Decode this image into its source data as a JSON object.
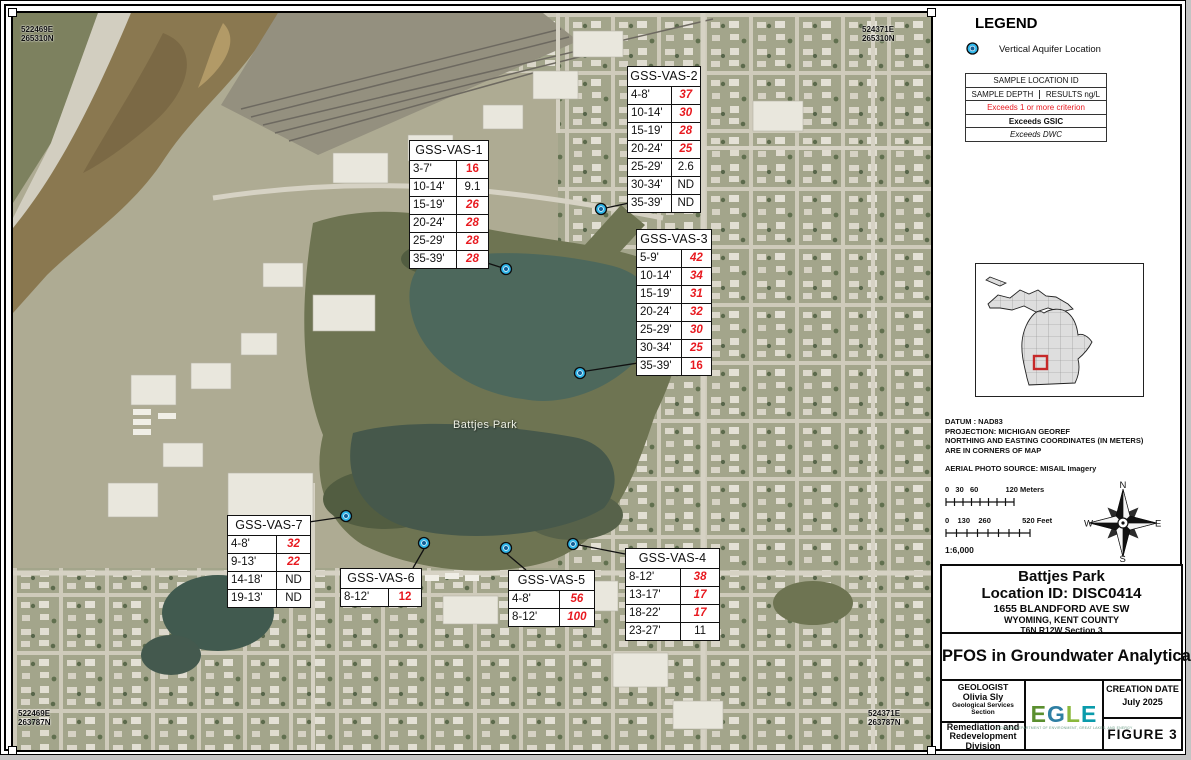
{
  "map": {
    "park_label": "Battjes Park",
    "corners": {
      "tl": {
        "e": "522469E",
        "n": "265310N"
      },
      "tr": {
        "e": "524371E",
        "n": "265310N"
      },
      "bl": {
        "e": "522469E",
        "n": "263787N"
      },
      "br": {
        "e": "524371E",
        "n": "263787N"
      }
    }
  },
  "stations": [
    {
      "name": "GSS-VAS-1",
      "table": {
        "x": 396,
        "y": 127,
        "w": 78
      },
      "marker": {
        "x": 493,
        "y": 256
      },
      "line": [
        468,
        248,
        493,
        256
      ],
      "rows": [
        {
          "depth": "3-7'",
          "value": "16",
          "style": "red_bold"
        },
        {
          "depth": "10-14'",
          "value": "9.1",
          "style": "plain"
        },
        {
          "depth": "15-19'",
          "value": "26",
          "style": "red_bold_italic"
        },
        {
          "depth": "20-24'",
          "value": "28",
          "style": "red_bold_italic"
        },
        {
          "depth": "25-29'",
          "value": "28",
          "style": "red_bold_italic"
        },
        {
          "depth": "35-39'",
          "value": "28",
          "style": "red_bold_italic"
        }
      ]
    },
    {
      "name": "GSS-VAS-2",
      "table": {
        "x": 614,
        "y": 53,
        "w": 72
      },
      "marker": {
        "x": 588,
        "y": 196
      },
      "line": [
        616,
        190,
        588,
        196
      ],
      "rows": [
        {
          "depth": "4-8'",
          "value": "37",
          "style": "red_bold_italic"
        },
        {
          "depth": "10-14'",
          "value": "30",
          "style": "red_bold_italic"
        },
        {
          "depth": "15-19'",
          "value": "28",
          "style": "red_bold_italic"
        },
        {
          "depth": "20-24'",
          "value": "25",
          "style": "red_bold_italic"
        },
        {
          "depth": "25-29'",
          "value": "2.6",
          "style": "plain"
        },
        {
          "depth": "30-34'",
          "value": "ND",
          "style": "plain"
        },
        {
          "depth": "35-39'",
          "value": "ND",
          "style": "plain"
        }
      ]
    },
    {
      "name": "GSS-VAS-3",
      "table": {
        "x": 623,
        "y": 216,
        "w": 74
      },
      "marker": {
        "x": 567,
        "y": 360
      },
      "line": [
        625,
        350,
        567,
        359
      ],
      "rows": [
        {
          "depth": "5-9'",
          "value": "42",
          "style": "red_bold_italic"
        },
        {
          "depth": "10-14'",
          "value": "34",
          "style": "red_bold_italic"
        },
        {
          "depth": "15-19'",
          "value": "31",
          "style": "red_bold_italic"
        },
        {
          "depth": "20-24'",
          "value": "32",
          "style": "red_bold_italic"
        },
        {
          "depth": "25-29'",
          "value": "30",
          "style": "red_bold_italic"
        },
        {
          "depth": "30-34'",
          "value": "25",
          "style": "red_bold_italic"
        },
        {
          "depth": "35-39'",
          "value": "16",
          "style": "red_bold"
        }
      ]
    },
    {
      "name": "GSS-VAS-7",
      "table": {
        "x": 214,
        "y": 502,
        "w": 82
      },
      "marker": {
        "x": 333,
        "y": 503
      },
      "line": [
        296,
        509,
        330,
        504
      ],
      "rows": [
        {
          "depth": "4-8'",
          "value": "32",
          "style": "red_bold_italic"
        },
        {
          "depth": "9-13'",
          "value": "22",
          "style": "red_bold_italic"
        },
        {
          "depth": "14-18'",
          "value": "ND",
          "style": "plain"
        },
        {
          "depth": "19-13'",
          "value": "ND",
          "style": "plain"
        }
      ]
    },
    {
      "name": "GSS-VAS-6",
      "table": {
        "x": 327,
        "y": 555,
        "w": 80
      },
      "marker": {
        "x": 411,
        "y": 530
      },
      "line": [
        400,
        555,
        411,
        536
      ],
      "rows": [
        {
          "depth": "8-12'",
          "value": "12",
          "style": "red_bold"
        }
      ]
    },
    {
      "name": "GSS-VAS-5",
      "table": {
        "x": 495,
        "y": 557,
        "w": 85
      },
      "marker": {
        "x": 493,
        "y": 535
      },
      "line": [
        513,
        557,
        494,
        541
      ],
      "rows": [
        {
          "depth": "4-8'",
          "value": "56",
          "style": "red_bold_italic"
        },
        {
          "depth": "8-12'",
          "value": "100",
          "style": "red_bold_italic"
        }
      ]
    },
    {
      "name": "GSS-VAS-4",
      "table": {
        "x": 612,
        "y": 535,
        "w": 93
      },
      "marker": {
        "x": 560,
        "y": 531
      },
      "line": [
        612,
        541,
        566,
        532
      ],
      "rows": [
        {
          "depth": "8-12'",
          "value": "38",
          "style": "red_bold_italic"
        },
        {
          "depth": "13-17'",
          "value": "17",
          "style": "red_bold_italic"
        },
        {
          "depth": "18-22'",
          "value": "17",
          "style": "red_bold_italic"
        },
        {
          "depth": "23-27'",
          "value": "11",
          "style": "plain"
        }
      ]
    }
  ],
  "legend": {
    "title": "LEGEND",
    "aquifer_label": "Vertical Aquifer Location"
  },
  "key_box": {
    "header": "SAMPLE LOCATION ID",
    "depth_col": "SAMPLE DEPTH",
    "results_col": "RESULTS ng/L",
    "criterion": "Exceeds 1 or more criterion",
    "gsic": "Exceeds GSIC",
    "dwc": "Exceeds DWC"
  },
  "notes": {
    "l1": "DATUM : NAD83",
    "l2": "PROJECTION: MICHIGAN GEOREF",
    "l3": "NORTHING AND EASTING COORDINATES (IN METERS)",
    "l4": "ARE IN CORNERS OF MAP",
    "l5": "AERIAL PHOTO SOURCE: MISAIL Imagery"
  },
  "scale": {
    "meters_label": "0   30   60             120 Meters",
    "feet_label": "0    130    260               520 Feet",
    "ratio": "1:6,000"
  },
  "compass": {
    "n": "N",
    "e": "E",
    "s": "S",
    "w": "W"
  },
  "title_block": {
    "site": "Battjes Park",
    "location_id": "Location ID: DISC0414",
    "address": "1655 BLANDFORD AVE SW",
    "city": "WYOMING, KENT COUNTY",
    "township": "T6N R12W Section 3",
    "subject": "PFOS in Groundwater Analytical",
    "geologist_label": "GEOLOGIST",
    "geologist_name": "Olivia Sly",
    "geologist_section": "Geological Services Section",
    "division": "Remediation and Redevelopment Division",
    "logo_e1": "E",
    "logo_g": "G",
    "logo_l": "L",
    "logo_e2": "E",
    "logo_caption": "MICHIGAN DEPARTMENT OF ENVIRONMENT, GREAT LAKES, AND ENERGY",
    "creation_label": "CREATION DATE",
    "creation_date": "July 2025",
    "figure": "FIGURE  3"
  },
  "colors": {
    "exceedance_red": "#e8191f",
    "marker_fill": "#2eb6ea",
    "marker_core": "#135e96",
    "county_highlight_red": "#c62828"
  }
}
